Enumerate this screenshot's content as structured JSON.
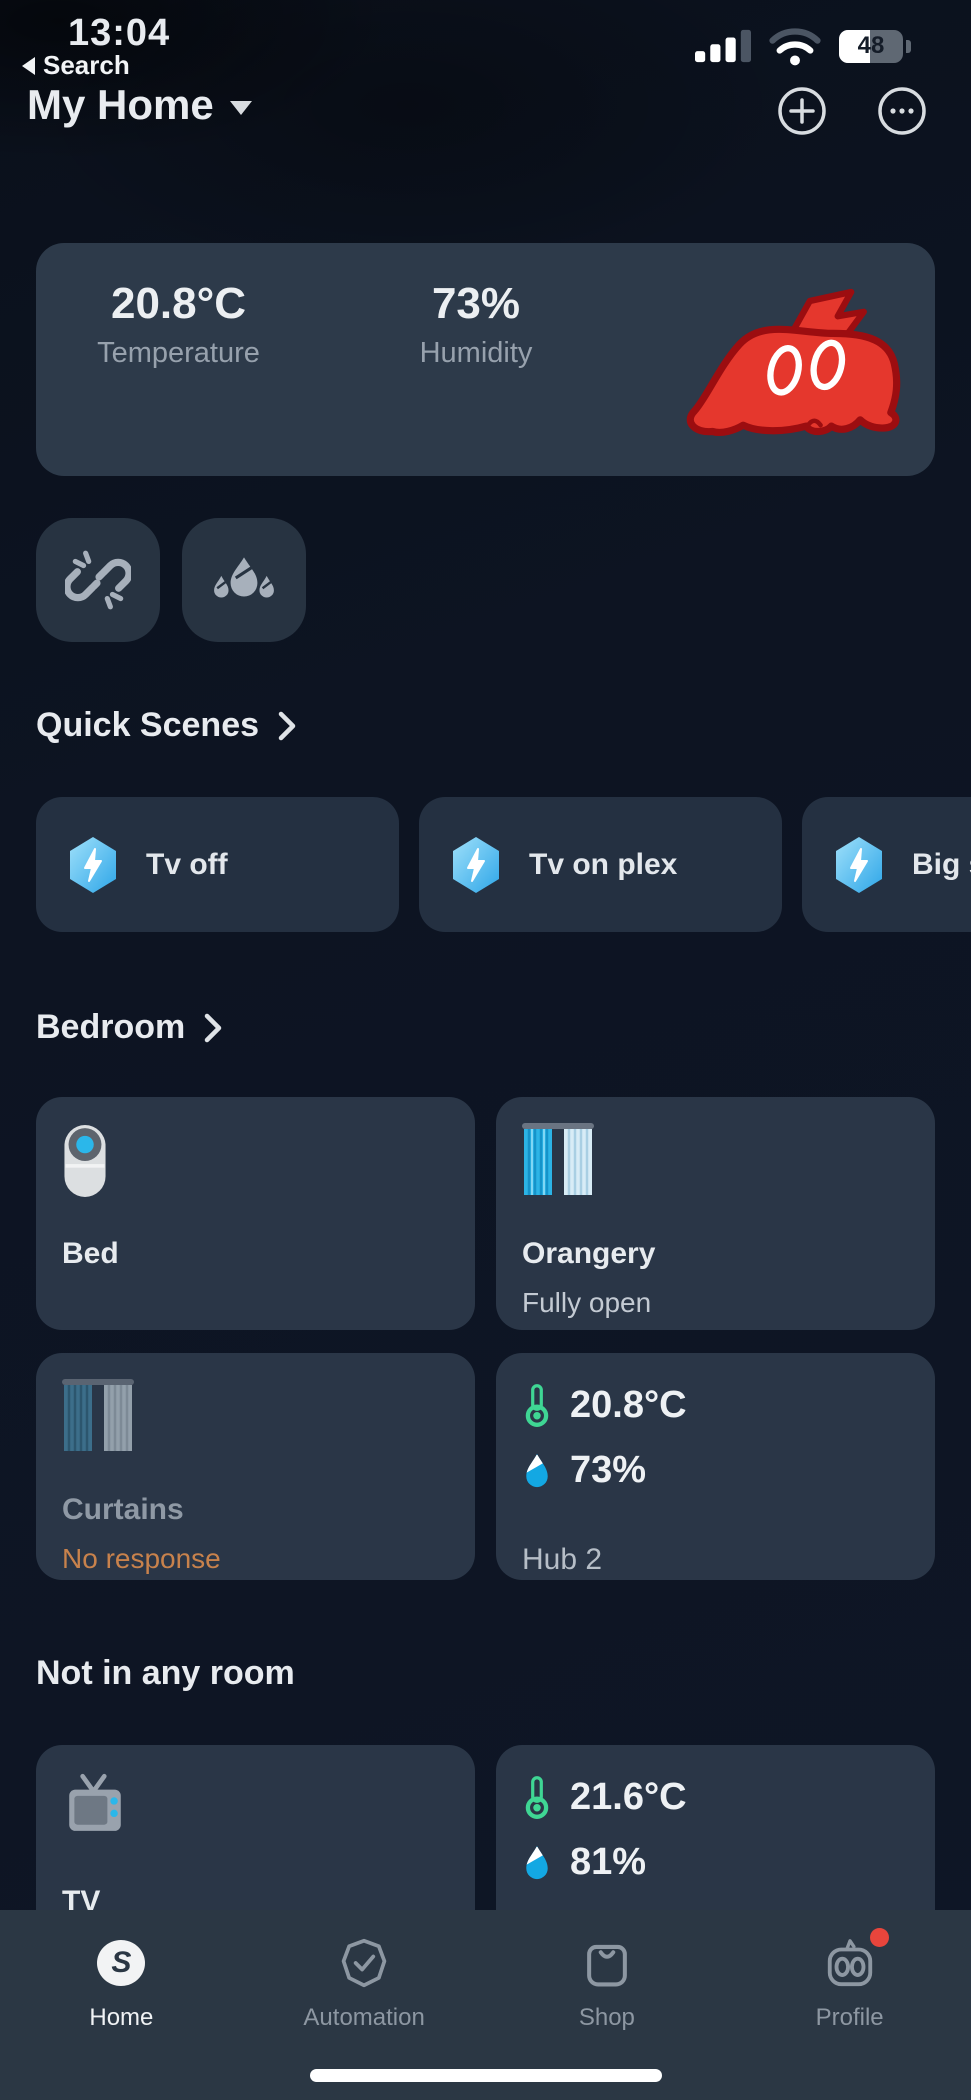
{
  "colors": {
    "accent_blue": "#46b7ee",
    "thermometer_green": "#3fd694",
    "drop_blue": "#13a8e3",
    "offline_orange": "#c8824c",
    "mascot_red": "#e5372d",
    "badge_red": "#e8453c",
    "card_bg": "#2a3647",
    "tabbar_bg": "#2b3744"
  },
  "status_bar": {
    "time": "13:04",
    "battery_percent": "48"
  },
  "nav": {
    "back_label": "Search"
  },
  "header": {
    "title": "My Home"
  },
  "summary_card": {
    "temperature_value": "20.8°C",
    "temperature_label": "Temperature",
    "humidity_value": "73%",
    "humidity_label": "Humidity",
    "mascot": "red-monster-with-lightning-bolt"
  },
  "quick_buttons": [
    {
      "icon": "broken-link-icon"
    },
    {
      "icon": "water-drops-icon"
    }
  ],
  "quick_scenes": {
    "title": "Quick Scenes",
    "items": [
      {
        "label": "Tv off",
        "icon": "scene-hexagon-lightning-icon"
      },
      {
        "label": "Tv on plex",
        "icon": "scene-hexagon-lightning-icon"
      },
      {
        "label": "Big s",
        "icon": "scene-hexagon-lightning-icon"
      }
    ]
  },
  "bedroom": {
    "title": "Bedroom",
    "devices": {
      "bed": {
        "name": "Bed",
        "icon": "smart-button-device-icon"
      },
      "orangery": {
        "name": "Orangery",
        "status": "Fully open",
        "icon": "curtains-open-icon"
      },
      "curtains": {
        "name": "Curtains",
        "status": "No response",
        "icon": "curtains-offline-icon"
      },
      "hub": {
        "name": "Hub 2",
        "temperature": "20.8°C",
        "humidity": "73%"
      }
    }
  },
  "not_in_any_room": {
    "title": "Not in any room",
    "devices": {
      "tv": {
        "name": "TV",
        "icon": "tv-icon"
      },
      "sensor": {
        "temperature": "21.6°C",
        "humidity": "81%"
      }
    }
  },
  "tab_bar": {
    "items": [
      {
        "label": "Home"
      },
      {
        "label": "Automation"
      },
      {
        "label": "Shop"
      },
      {
        "label": "Profile"
      }
    ]
  }
}
